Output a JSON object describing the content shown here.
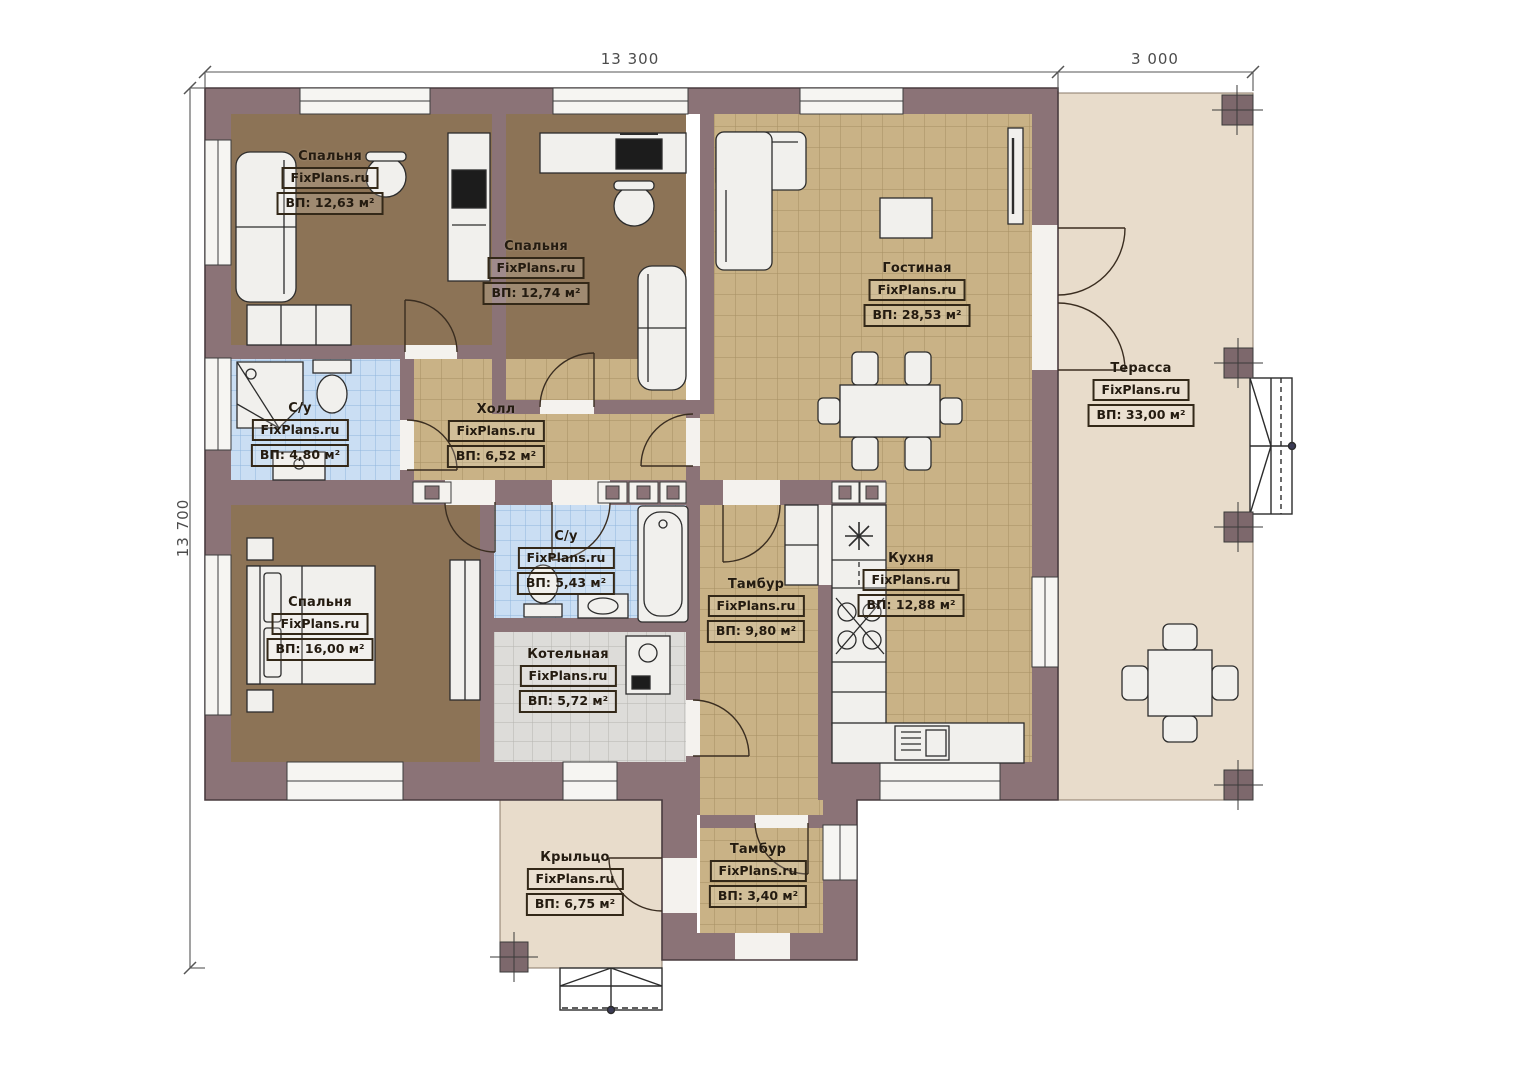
{
  "watermark": "FixPlans.ru",
  "dimensions": {
    "top_main": "13 300",
    "top_terrace": "3 000",
    "left": "13 700"
  },
  "rooms": [
    {
      "id": "bedroom-1",
      "name": "Спальня",
      "area": "ВП: 12,63 м²"
    },
    {
      "id": "bedroom-2",
      "name": "Спальня",
      "area": "ВП: 12,74 м²"
    },
    {
      "id": "living",
      "name": "Гостиная",
      "area": "ВП: 28,53 м²"
    },
    {
      "id": "terrace",
      "name": "Терасса",
      "area": "ВП: 33,00 м²"
    },
    {
      "id": "bath-1",
      "name": "С/у",
      "area": "ВП: 4,80 м²"
    },
    {
      "id": "hall",
      "name": "Холл",
      "area": "ВП: 6,52 м²"
    },
    {
      "id": "bath-2",
      "name": "С/у",
      "area": "ВП: 5,43 м²"
    },
    {
      "id": "bedroom-3",
      "name": "Спальня",
      "area": "ВП: 16,00 м²"
    },
    {
      "id": "boiler",
      "name": "Котельная",
      "area": "ВП: 5,72 м²"
    },
    {
      "id": "tambur-1",
      "name": "Тамбур",
      "area": "ВП: 9,80 м²"
    },
    {
      "id": "kitchen",
      "name": "Кухня",
      "area": "ВП: 12,88 м²"
    },
    {
      "id": "porch",
      "name": "Крыльцо",
      "area": "ВП: 6,75 м²"
    },
    {
      "id": "tambur-2",
      "name": "Тамбур",
      "area": "ВП: 3,40 м²"
    }
  ],
  "colors": {
    "wall": "#8b7377",
    "bedroom_floor": "#8c7356",
    "tile_tan": "#c9b286",
    "tile_blue": "#cadef3",
    "tile_gray": "#dddcd9",
    "terrace": "#e8dccb",
    "furniture": "#f1f0ed",
    "dimension_text": "#4c4c4c"
  }
}
